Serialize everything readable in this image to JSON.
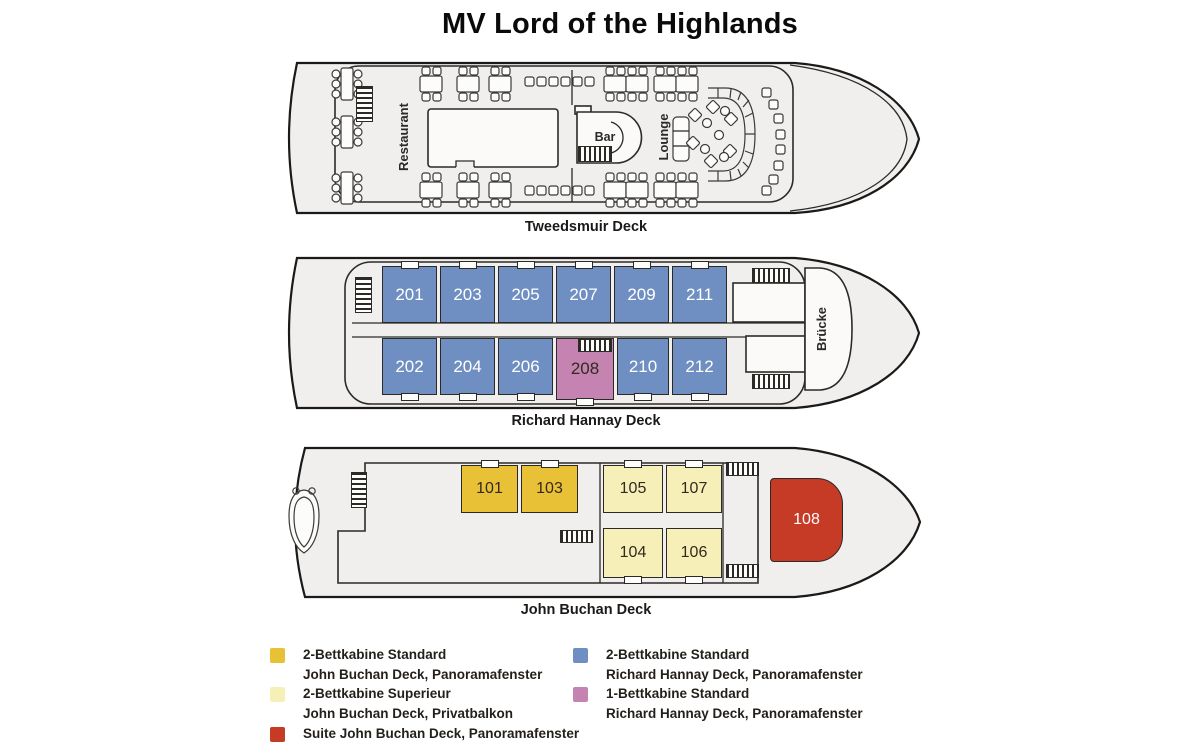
{
  "title": "MV Lord of the Highlands",
  "category_colors": {
    "standard_jb": "#e9c136",
    "superieur_jb": "#f6f0b8",
    "suite_jb": "#c53b26",
    "standard_rh": "#6f8fc2",
    "single_rh": "#c583b1"
  },
  "decks": {
    "tweedsmuir": {
      "caption": "Tweedsmuir Deck",
      "labels": {
        "restaurant": "Restaurant",
        "bar": "Bar",
        "lounge": "Lounge"
      }
    },
    "richard_hannay": {
      "caption": "Richard Hannay Deck",
      "labels": {
        "bridge": "Brücke"
      },
      "cabins": [
        {
          "number": "201",
          "category": "standard_rh"
        },
        {
          "number": "203",
          "category": "standard_rh"
        },
        {
          "number": "205",
          "category": "standard_rh"
        },
        {
          "number": "207",
          "category": "standard_rh"
        },
        {
          "number": "209",
          "category": "standard_rh"
        },
        {
          "number": "211",
          "category": "standard_rh"
        },
        {
          "number": "202",
          "category": "standard_rh"
        },
        {
          "number": "204",
          "category": "standard_rh"
        },
        {
          "number": "206",
          "category": "standard_rh"
        },
        {
          "number": "208",
          "category": "single_rh"
        },
        {
          "number": "210",
          "category": "standard_rh"
        },
        {
          "number": "212",
          "category": "standard_rh"
        }
      ]
    },
    "john_buchan": {
      "caption": "John Buchan Deck",
      "cabins": [
        {
          "number": "101",
          "category": "standard_jb"
        },
        {
          "number": "103",
          "category": "standard_jb"
        },
        {
          "number": "105",
          "category": "superieur_jb"
        },
        {
          "number": "107",
          "category": "superieur_jb"
        },
        {
          "number": "104",
          "category": "superieur_jb"
        },
        {
          "number": "106",
          "category": "superieur_jb"
        },
        {
          "number": "108",
          "category": "suite_jb"
        }
      ]
    }
  },
  "legend": {
    "columns": [
      {
        "items": [
          {
            "color_key": "standard_jb",
            "title": "2-Bettkabine Standard",
            "subtitle": "John Buchan Deck, Panoramafenster"
          },
          {
            "color_key": "superieur_jb",
            "title": "2-Bettkabine Superieur",
            "subtitle": "John Buchan Deck, Privatbalkon"
          },
          {
            "color_key": "suite_jb",
            "title": "Suite John Buchan Deck, Panoramafenster",
            "subtitle": ""
          }
        ]
      },
      {
        "items": [
          {
            "color_key": "standard_rh",
            "title": "2-Bettkabine Standard",
            "subtitle": "Richard Hannay Deck, Panoramafenster"
          },
          {
            "color_key": "single_rh",
            "title": "1-Bettkabine Standard",
            "subtitle": "Richard Hannay Deck, Panoramafenster"
          }
        ]
      }
    ]
  }
}
